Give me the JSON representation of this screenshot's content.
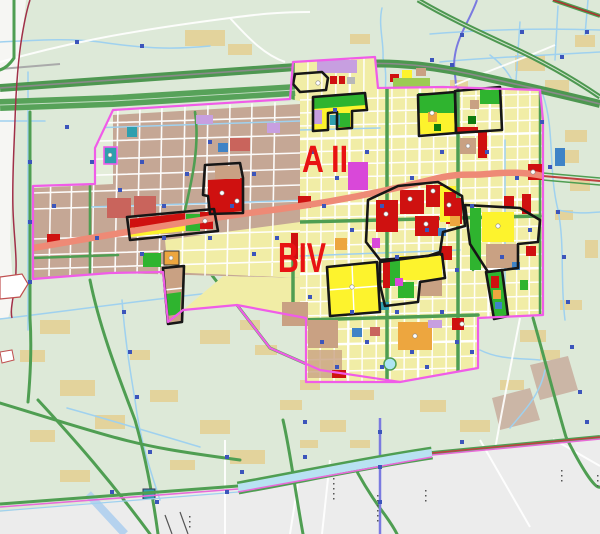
{
  "map": {
    "type": "urban-planning-zoning-map",
    "labels": {
      "district_a": {
        "text": "A II",
        "color": "#e81313"
      },
      "district_b": {
        "text": "BIV",
        "color": "#e81313"
      }
    },
    "palette": {
      "bg_rural": "#dde9d8",
      "bg_outside": "#ececec",
      "bg_white_edge": "#f6f6f3",
      "urban_yellow": "#f1eda6",
      "urban_tan": "#c5a795",
      "village_tan": "#e3d39c",
      "village_brown": "#cbb6a6",
      "parcel_red": "#cf1110",
      "parcel_rose": "#c9645c",
      "parcel_yellow_bright": "#fdf32d",
      "parcel_green": "#2fb42f",
      "parcel_green_dark": "#0f7a0f",
      "parcel_green_light": "#9ccb53",
      "parcel_orange": "#eda63f",
      "parcel_magenta": "#d948d9",
      "parcel_lavender": "#c79fe0",
      "parcel_blue": "#3f83c6",
      "parcel_teal": "#2f9fae",
      "parcel_tan": "#c9a183",
      "road_green": "#4f9e52",
      "road_green_band": "#57a259",
      "expressway_green": "#4d9750",
      "road_salmon": "#ee8a76",
      "road_red_thin": "#c04040",
      "canal_blue": "#9fd1ef",
      "canal_aqua": "#b8e2f2",
      "river_purple": "#7a7ae0",
      "boundary_magenta": "#f05ce8",
      "boundary_maroon": "#a03048",
      "outline_black": "#161616",
      "marker_blue": "#3c55bb",
      "label_red": "#e81313",
      "railway_dark": "#555555",
      "road_gray": "#aaaaaa"
    }
  }
}
